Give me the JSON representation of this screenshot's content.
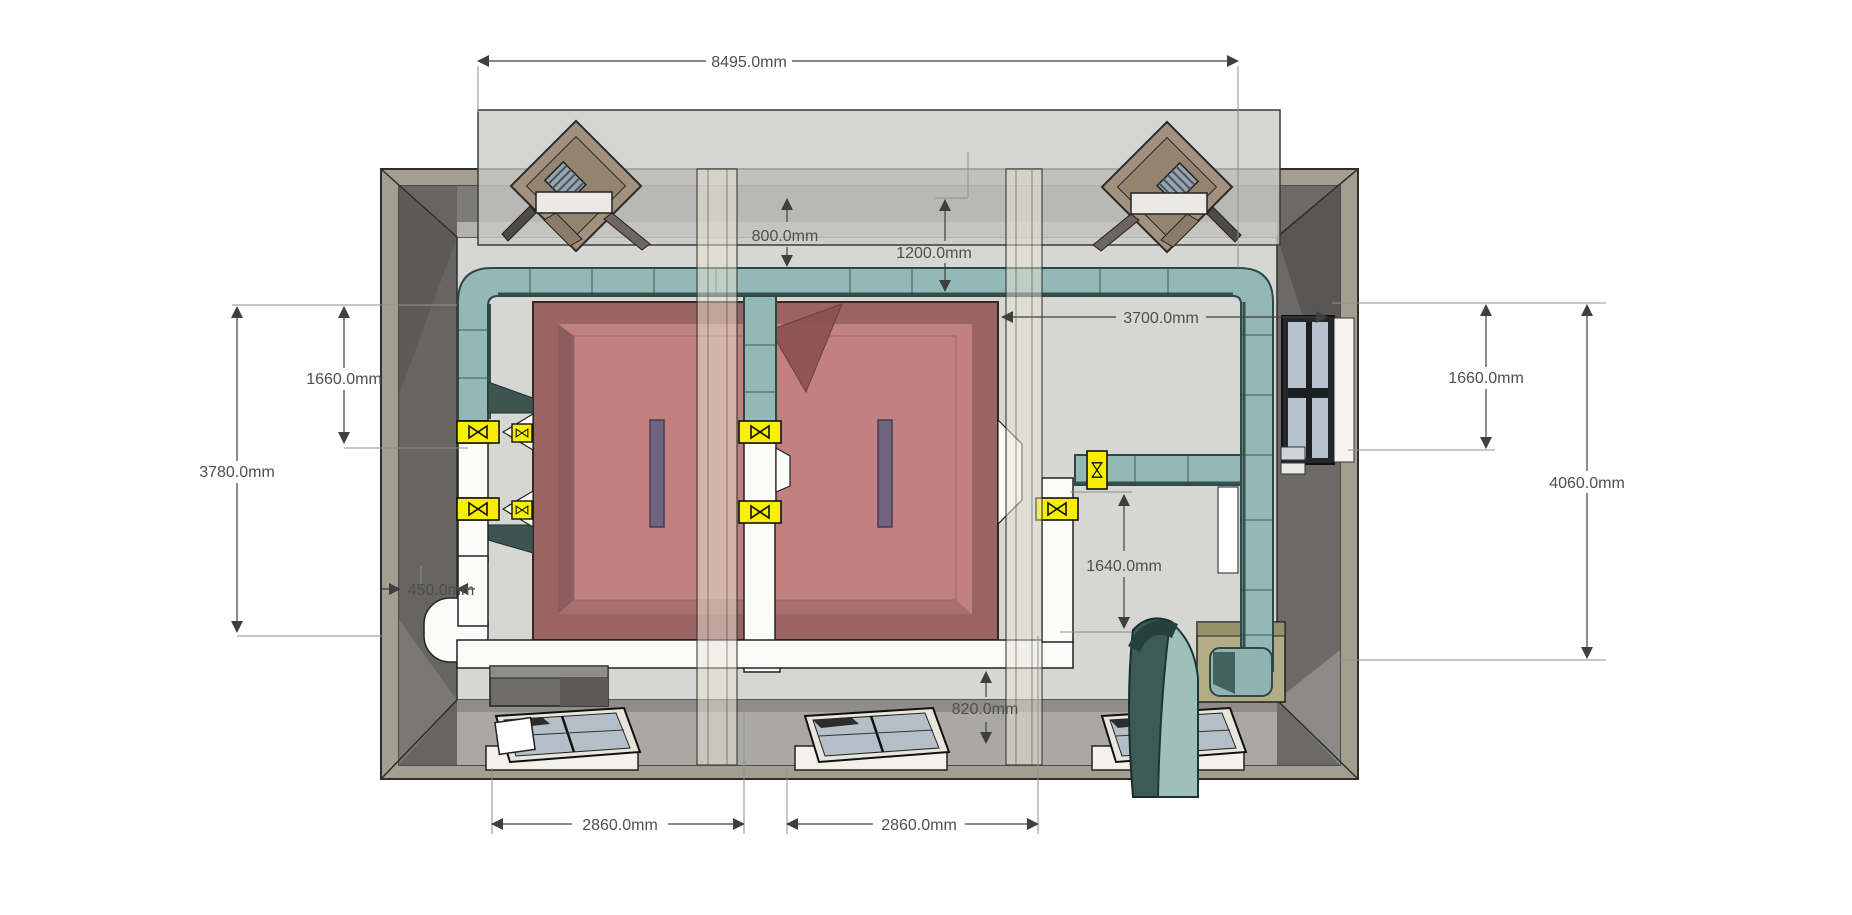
{
  "dimensions": {
    "overall_width": "8495.0mm",
    "duct_drop_top": "800.0mm",
    "duct_to_unit_top": "1200.0mm",
    "bay_width_3700": "3700.0mm",
    "left_upper_1660": "1660.0mm",
    "left_height_3780": "3780.0mm",
    "left_duct_450": "450.0mm",
    "right_upper_1660": "1660.0mm",
    "right_height_4060": "4060.0mm",
    "right_clearance_1640": "1640.0mm",
    "bottom_clearance_820": "820.0mm",
    "bottom_bay_left_2860": "2860.0mm",
    "bottom_bay_right_2860": "2860.0mm"
  },
  "colors": {
    "wall_outer": "#a49e90",
    "wall_inner": "#716f6b",
    "floor": "#d6d6d3",
    "roof_overlay": "#c9c9c6",
    "duct_teal": "#93b8b5",
    "duct_dark": "#3e5451",
    "valve_yellow": "#f7ee00",
    "unit_red_border": "#9c6363",
    "unit_red_top": "#c18181",
    "slot_purple": "#6f6380",
    "glass": "#b6c2cd",
    "dimension_text": "#4f4f4f"
  }
}
